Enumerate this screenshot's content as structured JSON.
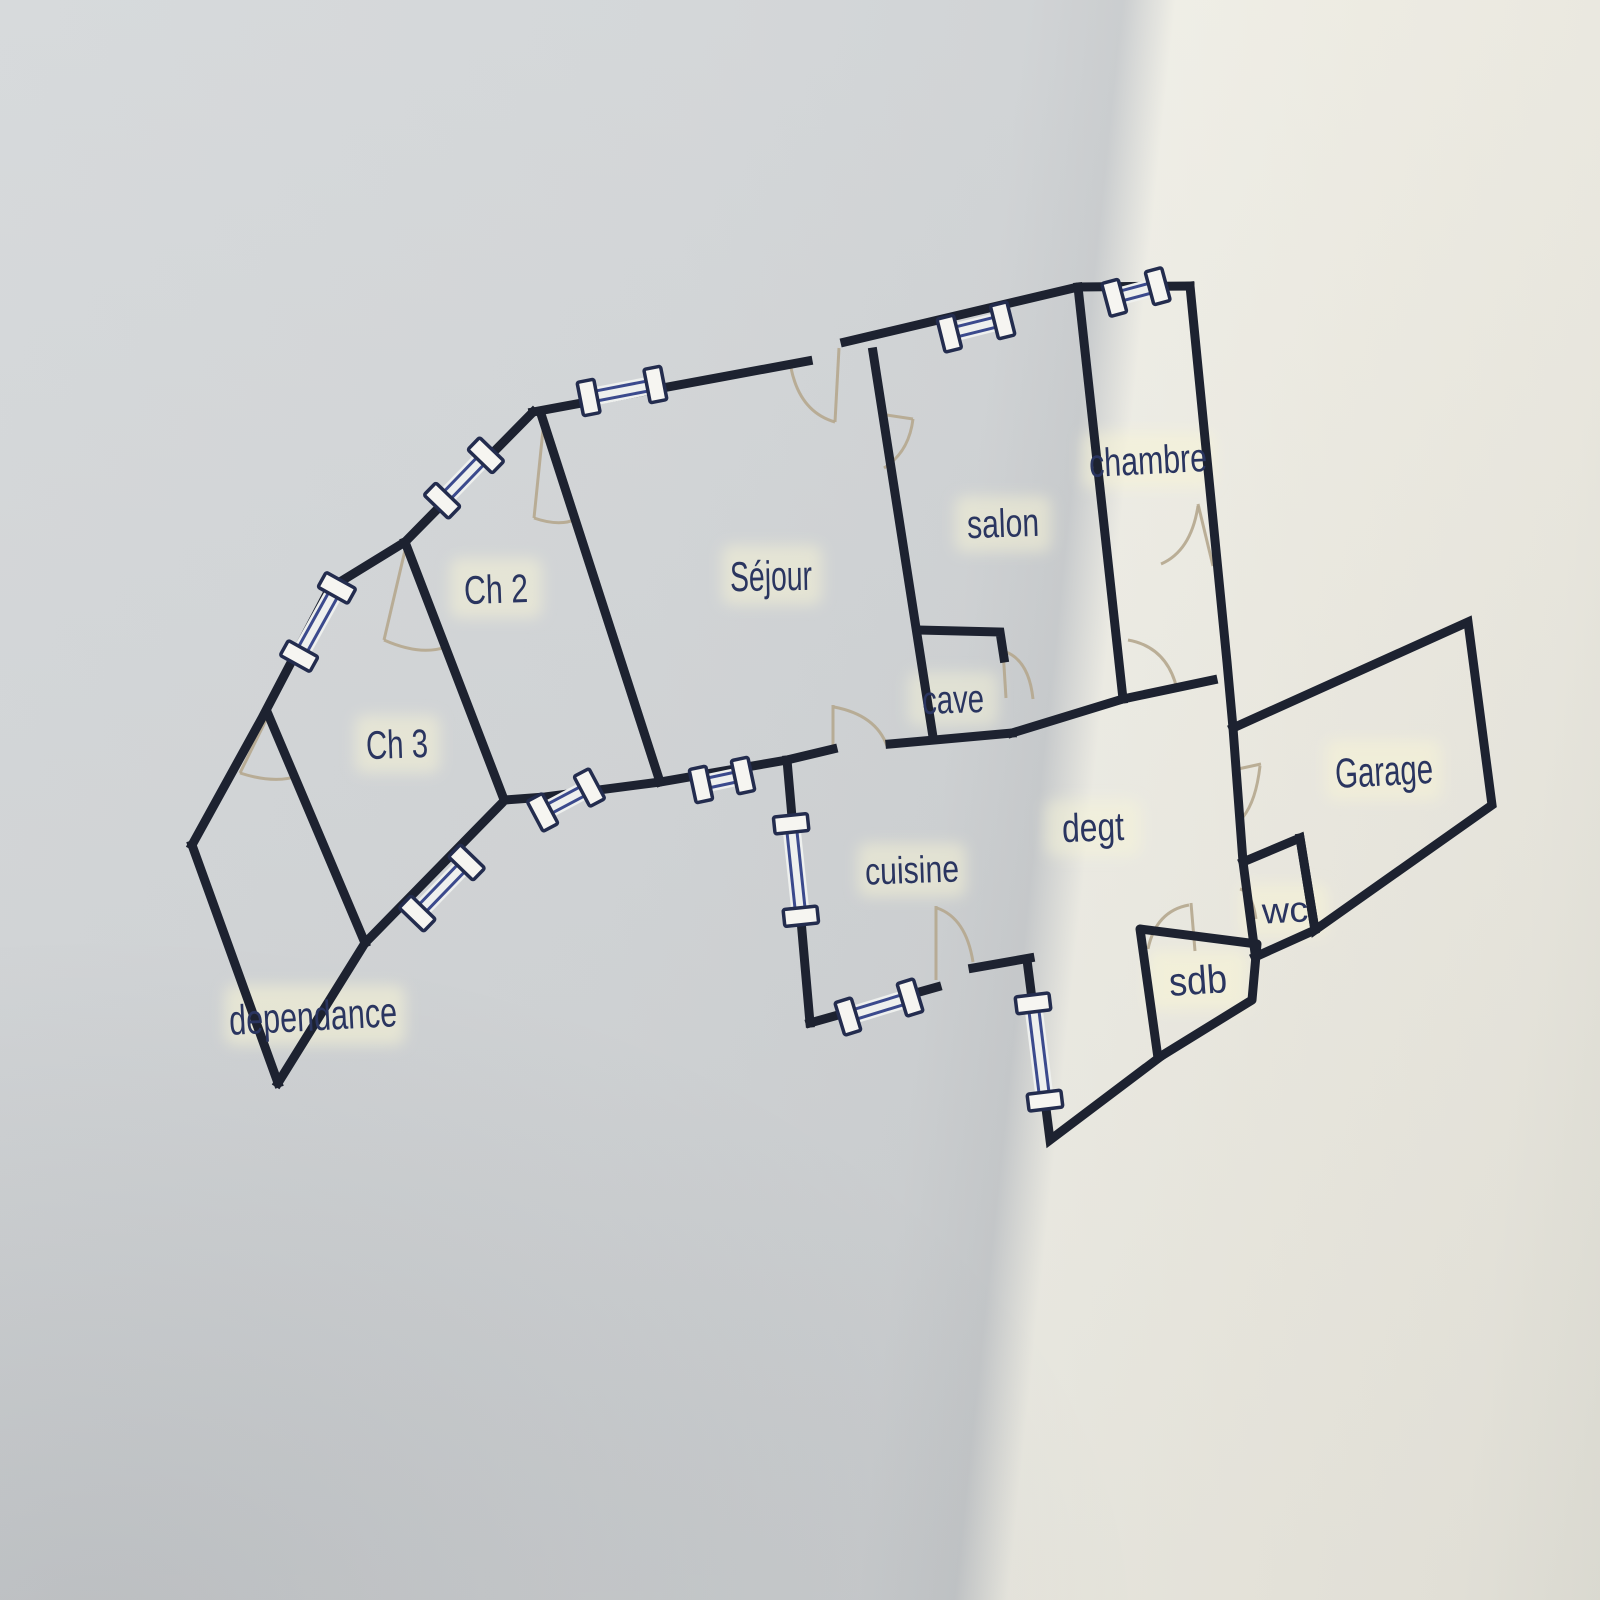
{
  "document": {
    "type": "floor-plan-photo",
    "language": "fr"
  },
  "rooms": {
    "dependance": {
      "label": "dependance"
    },
    "ch3": {
      "label": "Ch 3"
    },
    "ch2": {
      "label": "Ch 2"
    },
    "sejour": {
      "label": "Séjour"
    },
    "salon": {
      "label": "salon"
    },
    "chambre": {
      "label": "chambre"
    },
    "cave": {
      "label": "cave"
    },
    "degt": {
      "label": "degt"
    },
    "cuisine": {
      "label": "cuisine"
    },
    "sdb": {
      "label": "sdb"
    },
    "wc": {
      "label": "wc"
    },
    "garage": {
      "label": "Garage"
    }
  },
  "colors": {
    "wall": "#1d2230",
    "label": "#2a3560",
    "window_lines": "#3b4a8d",
    "window_cap_border": "#232c4e",
    "window_cap_fill": "#f6f5f1",
    "door_arc": "#b5a78e",
    "paper_left": "#d2d5d7",
    "paper_right": "#eceae1",
    "label_glow": "#f9f6d6"
  }
}
